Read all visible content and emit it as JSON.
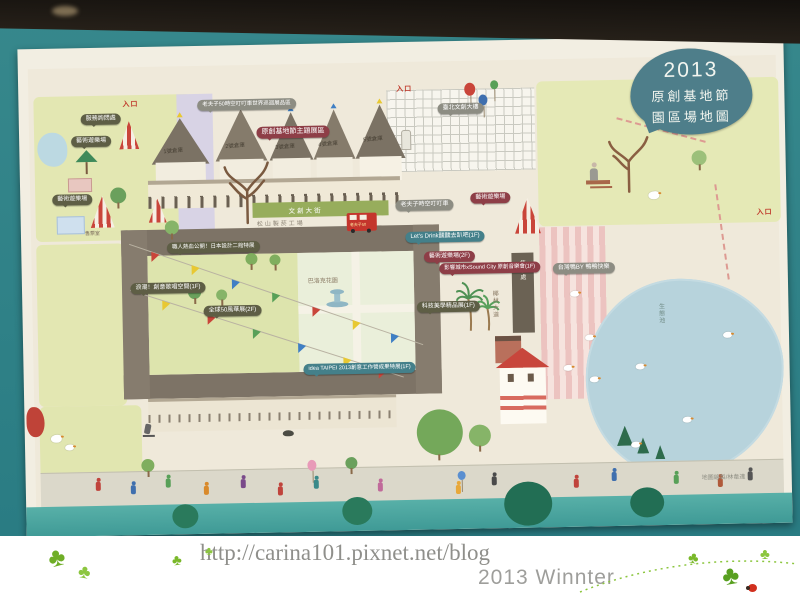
{
  "icons": {
    "clover": "♣"
  },
  "map": {
    "title": {
      "year": "2013",
      "line2": "原創基地節",
      "line3": "園區場地圖"
    },
    "entrance_label": "入口",
    "warehouses": [
      "1號倉庫",
      "2號倉庫",
      "3號倉庫",
      "4號倉庫",
      "5號倉庫"
    ],
    "labels": {
      "omq_expo": "老夫子50時空叮叮車世界巡迴展品區",
      "theme_zone": "原創基地節主題展區",
      "taipei_new_horizon": "臺北文創大樓",
      "service_info": "服務詢問處",
      "art_playground": "藝術遊樂場",
      "art_playground_2f": "藝術遊樂場(2F)",
      "ding_ding_tram": "老夫子時空叮叮車",
      "lets_drink": "Let's Drink醺醺去趴吧(1F)",
      "sound_city": "影響城市xSound City 原創音樂會(1F)",
      "craftsman_expo": "職人熱血公開！日本設計二館特展",
      "wave_song": "浪潮！創意歌唱空間(1F)",
      "fifty_expo": "全球50風華展(2F)",
      "tech_aesthetics": "科技美學精品展(1F)",
      "idea_taipei": "idea TAIPEI 2013創意工作營成果特展(1F)",
      "taiwan_duck": "台灣鴨BY 鴨鴨快樂",
      "ticket_room": "售票室"
    },
    "places": {
      "street": "文創大街",
      "factory": "松山製菸工場",
      "baroque_garden": "巴洛克花園",
      "palm_avenue": "椰林大道",
      "ticket_booth": "售票處",
      "eco_pond": "生態池",
      "bus": "老夫子50"
    },
    "credit": "地圖繪製/林韋達"
  },
  "footer": {
    "url": "http://carina101.pixnet.net/blog",
    "caption": "2013 Winnter"
  },
  "colors": {
    "title_bubble": "#4e7e8a",
    "olive_bubble": "#5e5e45",
    "darkred_bubble": "#8e3e47",
    "teal_bubble": "#44808a",
    "gray_bubble": "#8d8d83",
    "entrance_red": "#c0392b",
    "wall_teal": "#2f8187"
  }
}
